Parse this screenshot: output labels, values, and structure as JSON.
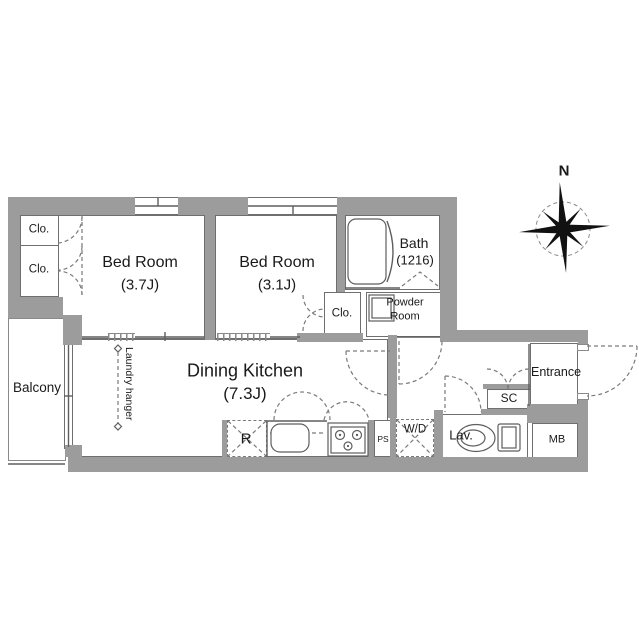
{
  "compass": {
    "north_label": "N"
  },
  "rooms": {
    "bedroom1": {
      "name": "Bed Room",
      "size": "(3.7J)"
    },
    "bedroom2": {
      "name": "Bed Room",
      "size": "(3.1J)"
    },
    "dining_kitchen": {
      "name": "Dining Kitchen",
      "size": "(7.3J)"
    },
    "bath": {
      "name": "Bath",
      "size": "(1216)"
    },
    "powder_room": {
      "line1": "Powder",
      "line2": "Room"
    },
    "balcony": {
      "name": "Balcony"
    },
    "entrance": {
      "name": "Entrance"
    }
  },
  "closets": {
    "clo1": "Clo.",
    "clo2": "Clo.",
    "clo3": "Clo."
  },
  "fixtures": {
    "refrigerator": "R",
    "pipe_space": "PS",
    "washer_dryer": "W/D",
    "lavatory": "Lav.",
    "shoe_closet": "SC",
    "meter_box": "MB",
    "laundry_hanger": "Laundry hanger"
  },
  "colors": {
    "wall": "#9c9c9c",
    "line": "#6f6f6f",
    "text": "#1a1a1a",
    "dash": "#7a7a7a"
  }
}
